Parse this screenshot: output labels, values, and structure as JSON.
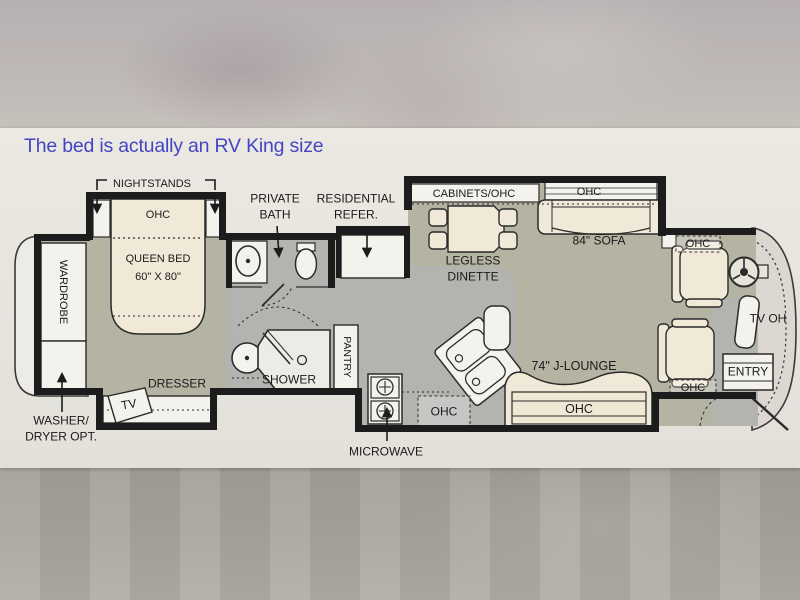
{
  "note": {
    "text": "The bed is actually an RV King size"
  },
  "colors": {
    "note_blue": "#4345c5",
    "wall_black": "#1c1c1c",
    "carpet_olive": "#b5b3a2",
    "tile_gray": "#b3b4b0",
    "furniture_cream": "#f0e9d8",
    "fixture_white": "#f4f2ec",
    "plan_band": "#e7e4de"
  },
  "labels": {
    "nightstands": "NIGHTSTANDS",
    "bed_ohc": "OHC",
    "queen_bed_line1": "QUEEN BED",
    "queen_bed_line2": "60\" X 80\"",
    "wardrobe": "WARDROBE",
    "washer_line1": "WASHER/",
    "washer_line2": "DRYER OPT.",
    "private_bath_line1": "PRIVATE",
    "private_bath_line2": "BATH",
    "refer_line1": "RESIDENTIAL",
    "refer_line2": "REFER.",
    "cabinets_ohc": "CABINETS/OHC",
    "sofa_ohc": "OHC",
    "sofa": "84\" SOFA",
    "dinette_line1": "LEGLESS",
    "dinette_line2": "DINETTE",
    "dresser": "DRESSER",
    "tv": "TV",
    "shower": "SHOWER",
    "pantry": "PANTRY",
    "microwave": "MICROWAVE",
    "kitchen_ohc": "OHC",
    "jlounge": "74\" J-LOUNGE",
    "jlounge_ohc": "OHC",
    "front_ohc_top": "OHC",
    "front_ohc_bottom": "OHC",
    "tv_oh": "TV OH",
    "entry": "ENTRY"
  }
}
